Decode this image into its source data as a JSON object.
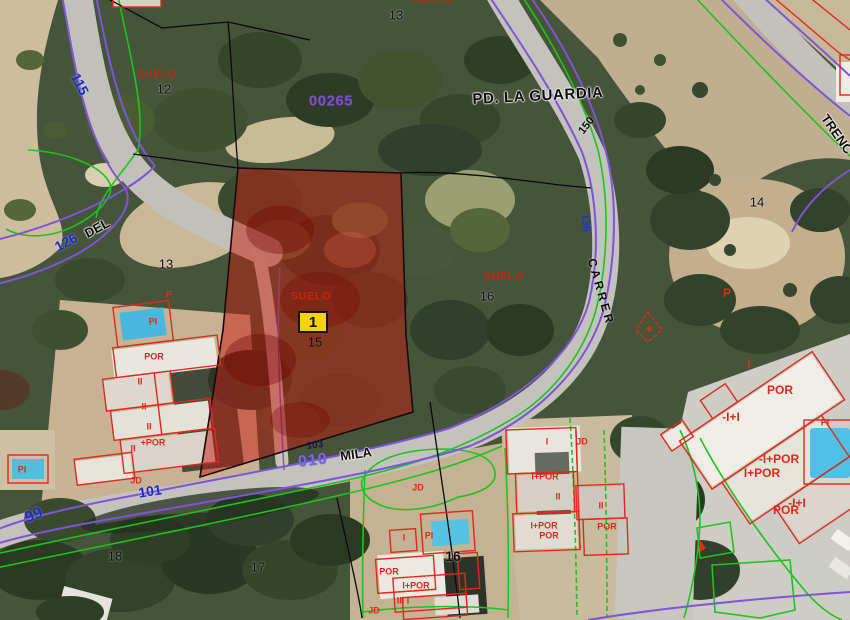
{
  "map": {
    "type": "cadastral-parcel-map-over-aerial-photo",
    "place_name": "PD. LA GUARDIA",
    "zone_code": "00265",
    "selected_parcel": {
      "marker_label": "1",
      "land_use_label": "SUELO",
      "parcel_number": "15"
    },
    "street_names": [
      "DEL",
      "MILA",
      "CARRER",
      "TRENC"
    ],
    "road_numbers": [
      "115",
      "126",
      "99",
      "101",
      "136",
      "150",
      "103",
      "010"
    ],
    "parcel_numbers": [
      "12",
      "13",
      "13",
      "14",
      "15",
      "16",
      "16",
      "17",
      "18"
    ],
    "land_use_codes": [
      "SUELO",
      "POR",
      "PI",
      "P",
      "JD",
      "II",
      "I",
      "I+POR",
      "-I+POR",
      "-I+I",
      "+POR",
      "III I"
    ],
    "colors": {
      "parcel_boundary_purple": "#7d55d8",
      "boundary_green": "#1dc41d",
      "building_outline_red": "#e0291b",
      "selected_parcel_fill": "rgba(198,28,18,0.5)",
      "marker_yellow": "#f6d20c",
      "road_number_blue": "#1c2bc4",
      "zone_code_purple": "#7b52cc",
      "suelo_red": "#c32514"
    }
  },
  "labels": [
    {
      "name": "road-115",
      "text": "115",
      "x": 80,
      "y": 84,
      "rot": 63,
      "cls": "roadnum"
    },
    {
      "name": "road-126",
      "text": "126",
      "x": 66,
      "y": 242,
      "rot": -28,
      "cls": "roadnum"
    },
    {
      "name": "street-del",
      "text": "DEL",
      "x": 97,
      "y": 228,
      "rot": -28,
      "cls": "street"
    },
    {
      "name": "road-99",
      "text": "99",
      "x": 34,
      "y": 516,
      "rot": -23,
      "cls": "roadnum-lg"
    },
    {
      "name": "road-101",
      "text": "101",
      "x": 150,
      "y": 491,
      "rot": -9,
      "cls": "roadnum"
    },
    {
      "name": "road-136",
      "text": "136",
      "x": 585,
      "y": 223,
      "rot": 82,
      "cls": "roadnum-sm"
    },
    {
      "name": "road-150",
      "text": "150",
      "x": 587,
      "y": 126,
      "rot": -52,
      "cls": "street-sm"
    },
    {
      "name": "zone-00265",
      "text": "00265",
      "x": 331,
      "y": 101,
      "rot": 0,
      "cls": "purplecode"
    },
    {
      "name": "road-010",
      "text": "010",
      "x": 313,
      "y": 461,
      "rot": -7,
      "cls": "purplenum"
    },
    {
      "name": "road-103",
      "text": "103",
      "x": 315,
      "y": 446,
      "rot": -7,
      "cls": "navynum"
    },
    {
      "name": "place-pd-la-guardia",
      "text": "PD. LA GUARDIA",
      "x": 538,
      "y": 96,
      "rot": -3,
      "cls": "place"
    },
    {
      "name": "street-mila",
      "text": "MILA",
      "x": 356,
      "y": 454,
      "rot": -8,
      "cls": "street"
    },
    {
      "name": "street-carrer",
      "text": "CARRER",
      "x": 601,
      "y": 292,
      "rot": 74,
      "cls": "street-sp"
    },
    {
      "name": "street-trenc",
      "text": "TRENC",
      "x": 837,
      "y": 134,
      "rot": 55,
      "cls": "street"
    },
    {
      "name": "parcel-12",
      "text": "12",
      "x": 164,
      "y": 89,
      "rot": 0,
      "cls": "pnum"
    },
    {
      "name": "parcel-13-top",
      "text": "13",
      "x": 396,
      "y": 15,
      "rot": 0,
      "cls": "pnum"
    },
    {
      "name": "parcel-13",
      "text": "13",
      "x": 166,
      "y": 264,
      "rot": 0,
      "cls": "pnum"
    },
    {
      "name": "parcel-14",
      "text": "14",
      "x": 757,
      "y": 202,
      "rot": 0,
      "cls": "pnum"
    },
    {
      "name": "parcel-15",
      "text": "15",
      "x": 315,
      "y": 342,
      "rot": 0,
      "cls": "pnum-dark"
    },
    {
      "name": "parcel-16",
      "text": "16",
      "x": 487,
      "y": 296,
      "rot": 0,
      "cls": "pnum"
    },
    {
      "name": "parcel-16b",
      "text": "16",
      "x": 453,
      "y": 556,
      "rot": 0,
      "cls": "pnum-lg"
    },
    {
      "name": "parcel-17",
      "text": "17",
      "x": 258,
      "y": 567,
      "rot": 0,
      "cls": "pnum"
    },
    {
      "name": "parcel-18",
      "text": "18",
      "x": 115,
      "y": 556,
      "rot": 0,
      "cls": "pnum"
    },
    {
      "name": "suelo-top",
      "text": "SUELO",
      "x": 434,
      "y": 0,
      "rot": 0,
      "cls": "suelo"
    },
    {
      "name": "suelo-12",
      "text": "SUELO",
      "x": 157,
      "y": 75,
      "rot": 0,
      "cls": "suelo"
    },
    {
      "name": "suelo-selected",
      "text": "SUELO",
      "x": 311,
      "y": 297,
      "rot": 0,
      "cls": "suelo"
    },
    {
      "name": "suelo-16",
      "text": "SUELO",
      "x": 504,
      "y": 277,
      "rot": 0,
      "cls": "suelo"
    },
    {
      "name": "bldg-p-left",
      "text": "P",
      "x": 169,
      "y": 295,
      "rot": 0,
      "cls": "bldg"
    },
    {
      "name": "bldg-pi-left",
      "text": "PI",
      "x": 153,
      "y": 322,
      "rot": 0,
      "cls": "bldg"
    },
    {
      "name": "bldg-por-left",
      "text": "POR",
      "x": 154,
      "y": 357,
      "rot": 0,
      "cls": "bldg"
    },
    {
      "name": "bldg-ii-1",
      "text": "II",
      "x": 140,
      "y": 382,
      "rot": 0,
      "cls": "bldg"
    },
    {
      "name": "bldg-ii-2",
      "text": "II",
      "x": 144,
      "y": 407,
      "rot": 0,
      "cls": "bldg"
    },
    {
      "name": "bldg-ii-3",
      "text": "II",
      "x": 149,
      "y": 427,
      "rot": 0,
      "cls": "bldg"
    },
    {
      "name": "bldg-plus-por",
      "text": "+POR",
      "x": 153,
      "y": 443,
      "rot": 0,
      "cls": "bldg"
    },
    {
      "name": "bldg-ii-4",
      "text": "II",
      "x": 133,
      "y": 449,
      "rot": 0,
      "cls": "bldg"
    },
    {
      "name": "bldg-jd-left",
      "text": "JD",
      "x": 136,
      "y": 481,
      "rot": 0,
      "cls": "bldg"
    },
    {
      "name": "bldg-pi-sw",
      "text": "PI",
      "x": 22,
      "y": 470,
      "rot": 0,
      "cls": "bldg"
    },
    {
      "name": "bldg-jd-center",
      "text": "JD",
      "x": 418,
      "y": 488,
      "rot": 0,
      "cls": "bldg"
    },
    {
      "name": "bldg-i-c1",
      "text": "I",
      "x": 404,
      "y": 538,
      "rot": 0,
      "cls": "bldg"
    },
    {
      "name": "bldg-pi-c1",
      "text": "PI",
      "x": 429,
      "y": 536,
      "rot": 0,
      "cls": "bldg"
    },
    {
      "name": "bldg-por-c1",
      "text": "POR",
      "x": 389,
      "y": 572,
      "rot": 0,
      "cls": "bldg"
    },
    {
      "name": "bldg-ipor-c1",
      "text": "I+POR",
      "x": 416,
      "y": 586,
      "rot": 0,
      "cls": "bldg"
    },
    {
      "name": "bldg-iiii-c1",
      "text": "III I",
      "x": 403,
      "y": 601,
      "rot": 0,
      "cls": "bldg"
    },
    {
      "name": "bldg-jd-c1",
      "text": "JD",
      "x": 374,
      "y": 611,
      "rot": 0,
      "cls": "bldg"
    },
    {
      "name": "bldg-i-c2",
      "text": "I",
      "x": 547,
      "y": 442,
      "rot": 0,
      "cls": "bldg"
    },
    {
      "name": "bldg-jd-c2",
      "text": "JD",
      "x": 582,
      "y": 442,
      "rot": 0,
      "cls": "bldg"
    },
    {
      "name": "bldg-ipor-c2a",
      "text": "I+POR",
      "x": 545,
      "y": 477,
      "rot": 0,
      "cls": "bldg"
    },
    {
      "name": "bldg-ii-c2a",
      "text": "II",
      "x": 558,
      "y": 497,
      "rot": 0,
      "cls": "bldg"
    },
    {
      "name": "bldg-ii-c2b",
      "text": "II",
      "x": 601,
      "y": 506,
      "rot": 0,
      "cls": "bldg"
    },
    {
      "name": "bldg-ipor-c2b",
      "text": "I+POR",
      "x": 544,
      "y": 526,
      "rot": 0,
      "cls": "bldg"
    },
    {
      "name": "bldg-por-c2a",
      "text": "POR",
      "x": 549,
      "y": 536,
      "rot": 0,
      "cls": "bldg"
    },
    {
      "name": "bldg-por-c2b",
      "text": "POR",
      "x": 607,
      "y": 527,
      "rot": 0,
      "cls": "bldg"
    },
    {
      "name": "bldg-p-right",
      "text": "P",
      "x": 727,
      "y": 293,
      "rot": 0,
      "cls": "bldg-lg"
    },
    {
      "name": "bldg-i-right",
      "text": "I",
      "x": 749,
      "y": 364,
      "rot": 0,
      "cls": "bldg-lg"
    },
    {
      "name": "bldg-por-r1",
      "text": "POR",
      "x": 780,
      "y": 390,
      "rot": 0,
      "cls": "bldg-lg"
    },
    {
      "name": "bldg-ii-r1",
      "text": "-I+I",
      "x": 731,
      "y": 417,
      "rot": 0,
      "cls": "bldg-lg"
    },
    {
      "name": "bldg-pi-right",
      "text": "PI",
      "x": 825,
      "y": 423,
      "rot": 0,
      "cls": "bldg"
    },
    {
      "name": "bldg-ipor-r1",
      "text": "-I+POR",
      "x": 779,
      "y": 459,
      "rot": 0,
      "cls": "bldg-lg"
    },
    {
      "name": "bldg-ipor-r2",
      "text": "I+POR",
      "x": 762,
      "y": 473,
      "rot": 0,
      "cls": "bldg-lg"
    },
    {
      "name": "bldg-ii-r2",
      "text": "-I+I",
      "x": 797,
      "y": 503,
      "rot": 0,
      "cls": "bldg-lg"
    },
    {
      "name": "bldg-por-r2",
      "text": "POR",
      "x": 786,
      "y": 510,
      "rot": 0,
      "cls": "bldg-lg"
    }
  ]
}
